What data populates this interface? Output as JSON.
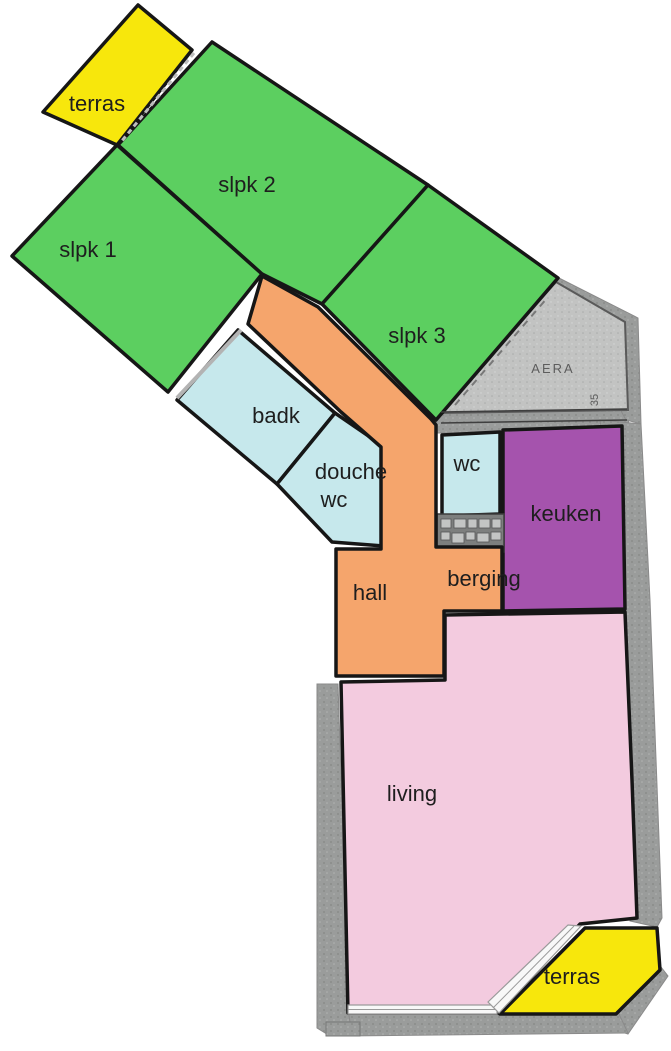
{
  "title": "Floor plan with colored rooms",
  "rooms": {
    "terras_top": {
      "label": "terras",
      "color": "#f7e70c"
    },
    "slpk1": {
      "label": "slpk 1",
      "color": "#5ccf60"
    },
    "slpk2": {
      "label": "slpk 2",
      "color": "#5ccf60"
    },
    "slpk3": {
      "label": "slpk 3",
      "color": "#5ccf60"
    },
    "badk": {
      "label": "badk",
      "color": "#c6e8ec"
    },
    "douche_wc": {
      "line1": "douche",
      "line2": "wc",
      "color": "#c6e8ec"
    },
    "wc": {
      "label": "wc",
      "color": "#c6e8ec"
    },
    "keuken": {
      "label": "keuken",
      "color": "#a553ad"
    },
    "hall": {
      "label": "hall",
      "color": "#f5a56c"
    },
    "berging": {
      "label": "berging",
      "color": "#f5a56c"
    },
    "living": {
      "label": "living",
      "color": "#f3cbdf"
    },
    "terras_bottom": {
      "label": "terras",
      "color": "#f7e70c"
    },
    "aera": {
      "label": "AERA",
      "area_number": "35",
      "color": "#c2c3c2"
    }
  },
  "walls": {
    "outline_color": "#161616",
    "masonry_color": "#9a9c9b"
  }
}
